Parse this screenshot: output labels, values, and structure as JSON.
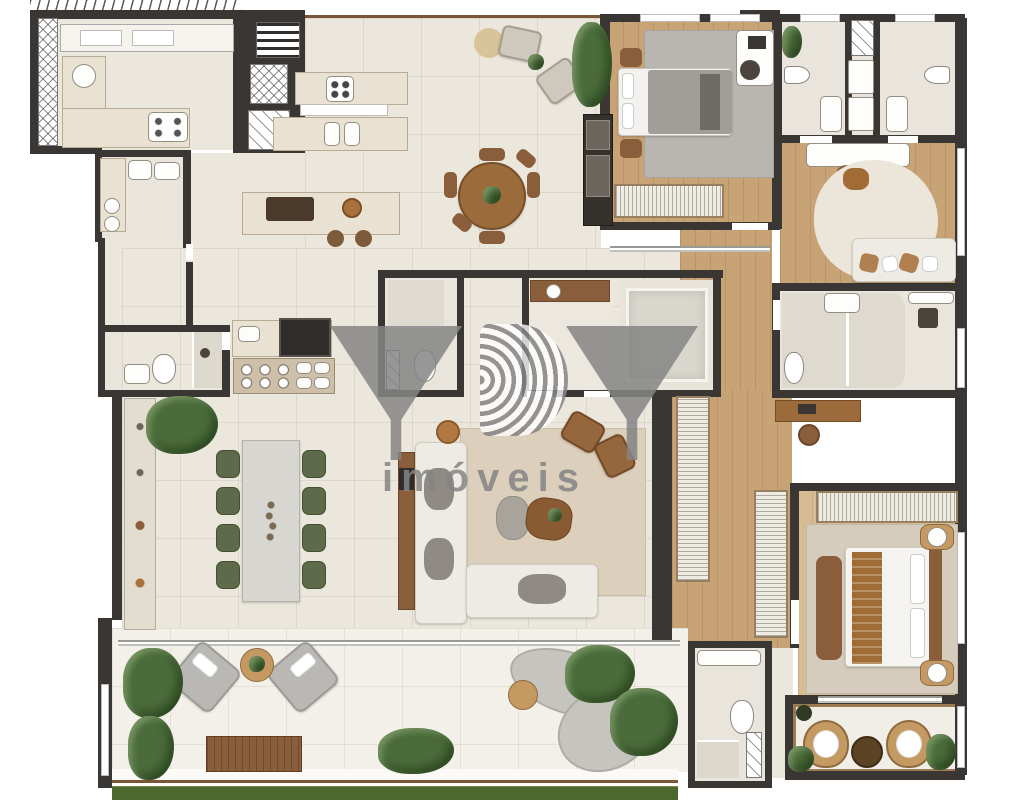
{
  "watermark": {
    "logo": "YBY",
    "subtitle": "imóveis"
  },
  "palette": {
    "wall": "#3a3633",
    "floor": "#ece7dd",
    "wood": "#c8a376",
    "grass": "#4c682c",
    "plant": "#4a6b3a",
    "green_chair": "#5d6b4a",
    "rattan": "#c49a62",
    "rug": "#dccfbb",
    "watermark": "#858585"
  }
}
